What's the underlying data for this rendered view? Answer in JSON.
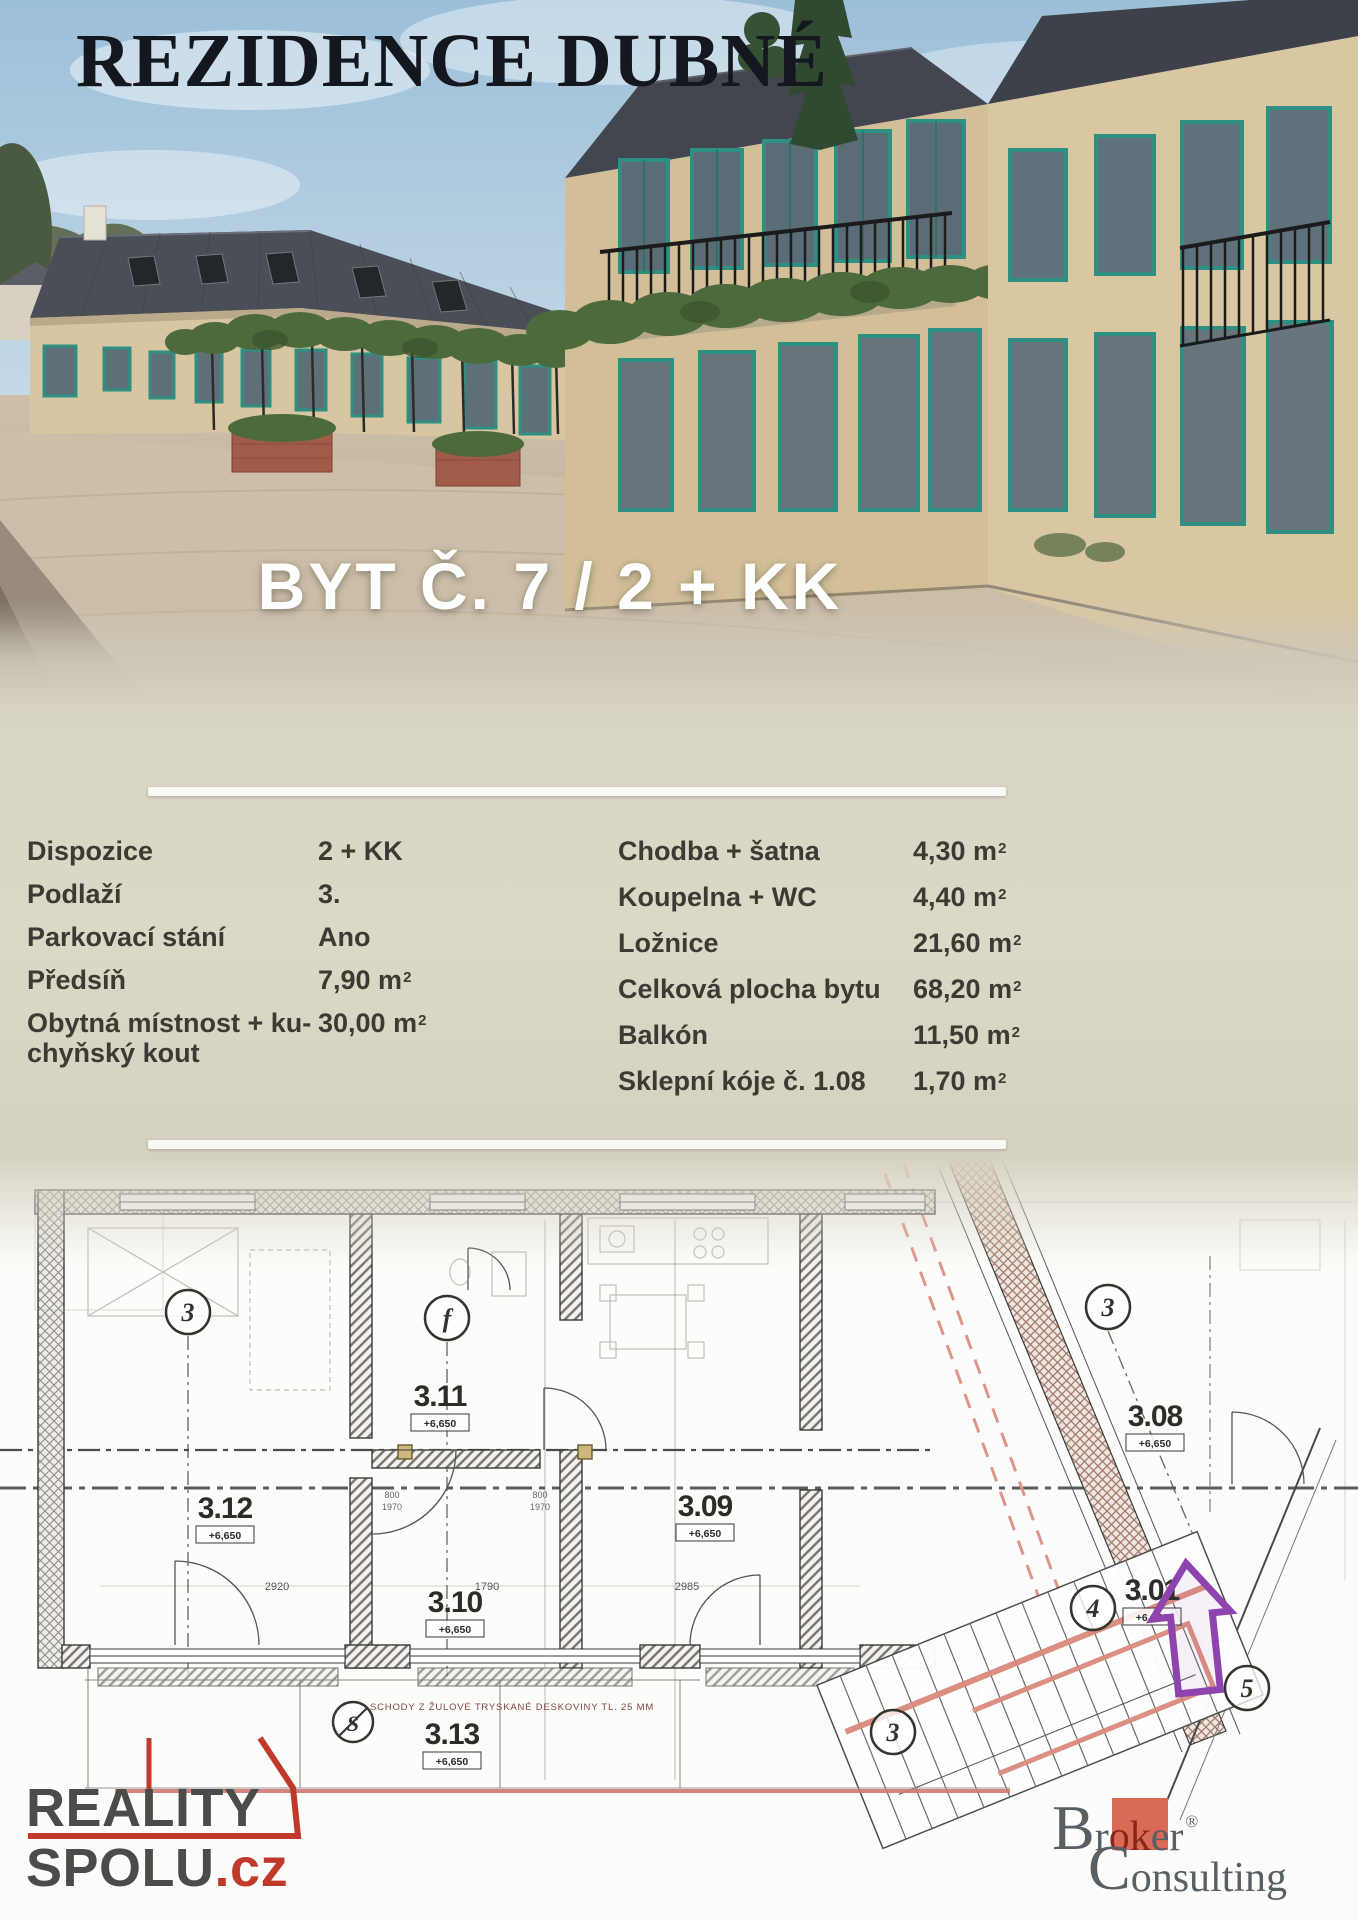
{
  "flyer": {
    "title": "REZIDENCE DUBNÉ",
    "unit_heading": "BYT Č. 7 / 2 + KK"
  },
  "specs": {
    "left": [
      {
        "label": "Dispozice",
        "value": "2 + KK",
        "exp": ""
      },
      {
        "label": "Podlaží",
        "value": "3.",
        "exp": ""
      },
      {
        "label": "Parkovací stání",
        "value": "Ano",
        "exp": ""
      },
      {
        "label": "Předsíň",
        "value": "7,90 m",
        "exp": "2"
      },
      {
        "label": "Obytná místnost + ku-chyňský kout",
        "value": "30,00 m",
        "exp": "2"
      }
    ],
    "right": [
      {
        "label": "Chodba + šatna",
        "value": "4,30 m",
        "exp": "2"
      },
      {
        "label": "Koupelna + WC",
        "value": "4,40 m",
        "exp": "2"
      },
      {
        "label": "Ložnice",
        "value": "21,60 m",
        "exp": "2"
      },
      {
        "label": "Celková plocha bytu",
        "value": "68,20 m",
        "exp": "2"
      },
      {
        "label": "Balkón",
        "value": "11,50 m",
        "exp": "2"
      },
      {
        "label": "Sklepní kóje č. 1.08",
        "value": "1,70 m",
        "exp": "2"
      }
    ]
  },
  "plan": {
    "rooms": {
      "r312": {
        "id": "3.12",
        "elev": "+6,650"
      },
      "r311": {
        "id": "3.11",
        "elev": "+6,650"
      },
      "r310": {
        "id": "3.10",
        "elev": "+6,650"
      },
      "r309": {
        "id": "3.09",
        "elev": "+6,650"
      },
      "r308": {
        "id": "3.08",
        "elev": "+6,650"
      },
      "r313": {
        "id": "3.13",
        "elev": "+6,650"
      },
      "r301": {
        "id": "3.01",
        "elev": "+6,650"
      }
    },
    "markers": {
      "m1": "3",
      "m2": "f",
      "m3": "3",
      "m4": "4",
      "m5": "5",
      "m6": "3",
      "m7": "S"
    },
    "dims": {
      "d1": "2920",
      "d2": "1790",
      "d3": "2985",
      "d4": "800",
      "d5": "1970",
      "d6": "800",
      "d7": "1970"
    },
    "note": "SCHODY Z ŽULOVÉ TRYSKANÉ DESKOVINY TL. 25 MM"
  },
  "logos": {
    "reality": {
      "word1": "REALITY",
      "word2": "SPOLU",
      "tld": ".cz"
    },
    "broker": {
      "cap1": "B",
      "seg1": "r",
      "boxed": "ok",
      "seg2": "er",
      "reg": "®",
      "cap2": "C",
      "seg3": "onsulting"
    }
  },
  "colors": {
    "accent_red": "#c0392b",
    "salmon_highlight": "#d98a7c",
    "arrow_purple": "#8e44ad",
    "window_teal": "#2e8f83",
    "broker_red": "#d96a55",
    "brand_gray": "#4b4b49",
    "panel_beige": "#d9d5c5",
    "text_dark": "#3b3a33"
  }
}
